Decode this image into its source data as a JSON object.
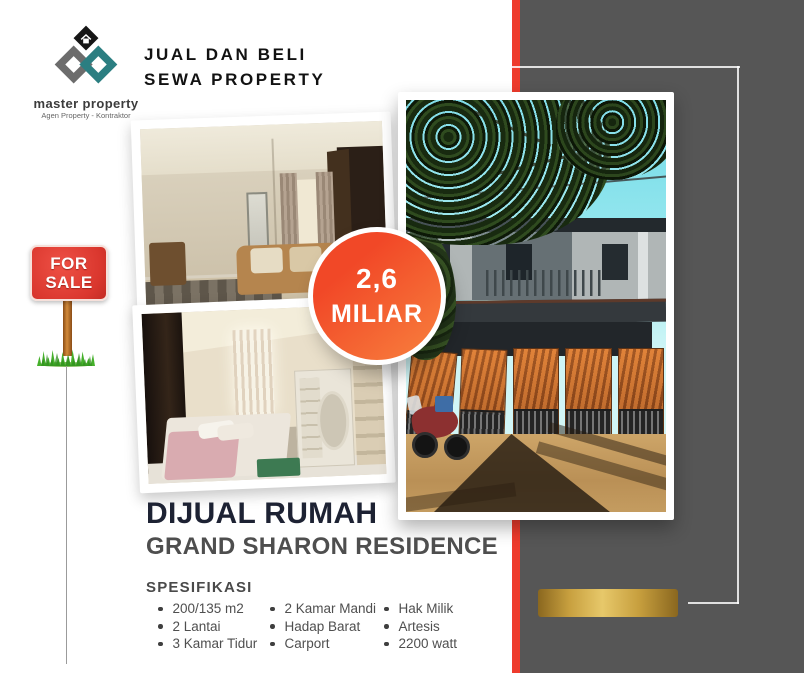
{
  "brand": {
    "name": "master property",
    "tagline": "Agen Property - Kontraktor",
    "header_line1": "JUAL DAN BELI",
    "header_line2": "SEWA PROPERTY"
  },
  "sale_sign": {
    "line1": "FOR",
    "line2": "SALE"
  },
  "price_badge": {
    "amount": "2,6",
    "unit": "MILIAR"
  },
  "listing": {
    "title": "DIJUAL RUMAH",
    "subtitle": "GRAND SHARON RESIDENCE",
    "spec_heading": "SPESIFIKASI",
    "spec_columns": [
      [
        "200/135 m2",
        "2 Lantai",
        "3 Kamar Tidur"
      ],
      [
        "2 Kamar Mandi",
        "Hadap Barat",
        "Carport"
      ],
      [
        "Hak Milik",
        "Artesis",
        "2200 watt"
      ]
    ]
  },
  "colors": {
    "accent_red": "#ee3b2c",
    "panel_gray": "#565656",
    "badge_gradient_start": "#f14827",
    "badge_gradient_end": "#f8813e",
    "gold": "#e7c86a",
    "sign_red": "#da372e",
    "logo_teal": "#2b7e81",
    "logo_gray": "#6c6c6c",
    "title_dark": "#1d2233",
    "text_gray": "#4f4f4f"
  }
}
